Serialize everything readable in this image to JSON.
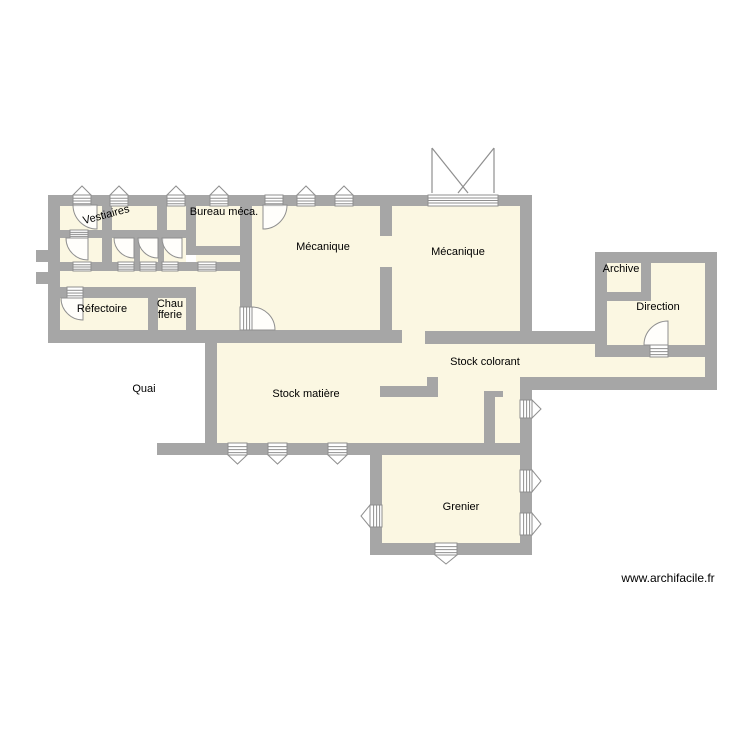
{
  "app": {
    "type": "floor-plan-export",
    "watermark": "www.archifacile.fr"
  },
  "colors": {
    "background": "#ffffff",
    "wall": "#a6a6a6",
    "room_fill": "#fbf7e2",
    "symbol_fill": "#ffffff",
    "symbol_stroke": "#8f8f8f",
    "label": "#000000"
  },
  "watermark_pos": {
    "x": 668,
    "y": 578
  },
  "rooms": [
    {
      "id": "vestiaires",
      "label": "Vestiaires",
      "x": 107,
      "y": 218,
      "rotate": -15
    },
    {
      "id": "bureau-meca",
      "label": "Bureau méca.",
      "x": 224,
      "y": 215
    },
    {
      "id": "mecanique-1",
      "label": "Mécanique",
      "x": 323,
      "y": 250
    },
    {
      "id": "mecanique-2",
      "label": "Mécanique",
      "x": 458,
      "y": 255
    },
    {
      "id": "archive",
      "label": "Archive",
      "x": 621,
      "y": 272
    },
    {
      "id": "direction",
      "label": "Direction",
      "x": 658,
      "y": 310
    },
    {
      "id": "refectoire",
      "label": "Réfectoire",
      "x": 102,
      "y": 312
    },
    {
      "id": "chaufferie",
      "label": "Chaufferie",
      "x": 170,
      "y": 311,
      "lines": [
        "Chau",
        "fferie"
      ]
    },
    {
      "id": "quai",
      "label": "Quai",
      "x": 144,
      "y": 392
    },
    {
      "id": "stock-matiere",
      "label": "Stock matière",
      "x": 306,
      "y": 397
    },
    {
      "id": "stock-colorant",
      "label": "Stock colorant",
      "x": 485,
      "y": 365
    },
    {
      "id": "grenier",
      "label": "Grenier",
      "x": 461,
      "y": 510
    }
  ],
  "geometry": {
    "room_fills": [
      [
        60,
        205,
        42,
        26
      ],
      [
        112,
        205,
        45,
        26
      ],
      [
        167,
        205,
        19,
        26
      ],
      [
        196,
        205,
        44,
        41
      ],
      [
        60,
        238,
        42,
        24
      ],
      [
        112,
        238,
        22,
        24
      ],
      [
        140,
        238,
        18,
        24
      ],
      [
        164,
        238,
        22,
        24
      ],
      [
        196,
        255,
        44,
        7
      ],
      [
        60,
        271,
        180,
        16
      ],
      [
        196,
        287,
        44,
        43
      ],
      [
        240,
        307,
        12,
        23
      ],
      [
        60,
        298,
        88,
        32
      ],
      [
        158,
        298,
        28,
        32
      ],
      [
        252,
        205,
        128,
        125
      ],
      [
        380,
        236,
        12,
        31
      ],
      [
        392,
        205,
        128,
        126
      ],
      [
        402,
        331,
        23,
        13
      ],
      [
        217,
        343,
        304,
        100
      ],
      [
        521,
        344,
        184,
        33
      ],
      [
        607,
        263,
        98,
        82
      ],
      [
        382,
        455,
        138,
        88
      ]
    ],
    "walls": [
      [
        48,
        195,
        484,
        11
      ],
      [
        48,
        195,
        12,
        148
      ],
      [
        36,
        250,
        12,
        12
      ],
      [
        36,
        272,
        12,
        12
      ],
      [
        102,
        205,
        10,
        26
      ],
      [
        157,
        205,
        10,
        26
      ],
      [
        186,
        205,
        10,
        50
      ],
      [
        60,
        230,
        126,
        8
      ],
      [
        186,
        246,
        66,
        9
      ],
      [
        102,
        238,
        10,
        24
      ],
      [
        134,
        238,
        6,
        24
      ],
      [
        158,
        238,
        6,
        24
      ],
      [
        60,
        262,
        192,
        9
      ],
      [
        48,
        287,
        148,
        11
      ],
      [
        148,
        298,
        10,
        32
      ],
      [
        186,
        298,
        10,
        32
      ],
      [
        48,
        330,
        354,
        13
      ],
      [
        205,
        330,
        12,
        125
      ],
      [
        240,
        195,
        12,
        112
      ],
      [
        380,
        195,
        12,
        41
      ],
      [
        380,
        267,
        12,
        63
      ],
      [
        520,
        195,
        12,
        136
      ],
      [
        425,
        331,
        107,
        13
      ],
      [
        427,
        377,
        11,
        20
      ],
      [
        380,
        386,
        58,
        11
      ],
      [
        484,
        391,
        19,
        6
      ],
      [
        484,
        397,
        11,
        46
      ],
      [
        532,
        331,
        75,
        13
      ],
      [
        595,
        252,
        122,
        11
      ],
      [
        595,
        252,
        12,
        105
      ],
      [
        705,
        252,
        12,
        138
      ],
      [
        607,
        292,
        44,
        9
      ],
      [
        641,
        263,
        10,
        38
      ],
      [
        595,
        345,
        122,
        12
      ],
      [
        520,
        377,
        197,
        13
      ],
      [
        520,
        390,
        12,
        165
      ],
      [
        157,
        443,
        226,
        12
      ],
      [
        383,
        443,
        149,
        12
      ],
      [
        370,
        443,
        12,
        112
      ],
      [
        370,
        543,
        162,
        12
      ]
    ],
    "windows_h": [
      {
        "x": 73,
        "y": 195,
        "w": 18,
        "h": 11,
        "tri": "up"
      },
      {
        "x": 110,
        "y": 195,
        "w": 18,
        "h": 11,
        "tri": "up"
      },
      {
        "x": 167,
        "y": 195,
        "w": 18,
        "h": 11,
        "tri": "up"
      },
      {
        "x": 210,
        "y": 195,
        "w": 18,
        "h": 11,
        "tri": "up"
      },
      {
        "x": 265,
        "y": 195,
        "w": 18,
        "h": 11,
        "tri": "none"
      },
      {
        "x": 297,
        "y": 195,
        "w": 18,
        "h": 11,
        "tri": "up"
      },
      {
        "x": 335,
        "y": 195,
        "w": 18,
        "h": 11,
        "tri": "up"
      },
      {
        "x": 70,
        "y": 230,
        "w": 18,
        "h": 8,
        "tri": "none"
      },
      {
        "x": 73,
        "y": 262,
        "w": 18,
        "h": 9,
        "tri": "none"
      },
      {
        "x": 118,
        "y": 262,
        "w": 16,
        "h": 9,
        "tri": "none"
      },
      {
        "x": 140,
        "y": 262,
        "w": 16,
        "h": 9,
        "tri": "none"
      },
      {
        "x": 162,
        "y": 262,
        "w": 16,
        "h": 9,
        "tri": "none"
      },
      {
        "x": 198,
        "y": 262,
        "w": 18,
        "h": 9,
        "tri": "none"
      },
      {
        "x": 67,
        "y": 287,
        "w": 16,
        "h": 11,
        "tri": "none"
      },
      {
        "x": 650,
        "y": 345,
        "w": 18,
        "h": 12,
        "tri": "none"
      },
      {
        "x": 228,
        "y": 443,
        "w": 19,
        "h": 12,
        "tri": "down"
      },
      {
        "x": 268,
        "y": 443,
        "w": 19,
        "h": 12,
        "tri": "down"
      },
      {
        "x": 328,
        "y": 443,
        "w": 19,
        "h": 12,
        "tri": "down"
      },
      {
        "x": 435,
        "y": 543,
        "w": 22,
        "h": 12,
        "tri": "down"
      }
    ],
    "windows_v": [
      {
        "x": 240,
        "y": 307,
        "w": 12,
        "h": 23,
        "tri": "none"
      },
      {
        "x": 520,
        "y": 400,
        "w": 12,
        "h": 18,
        "tri": "right"
      },
      {
        "x": 520,
        "y": 470,
        "w": 12,
        "h": 22,
        "tri": "right"
      },
      {
        "x": 520,
        "y": 513,
        "w": 12,
        "h": 22,
        "tri": "right"
      },
      {
        "x": 370,
        "y": 505,
        "w": 12,
        "h": 22,
        "tri": "left"
      }
    ],
    "doors": [
      "M97,205 L97,229 A24,24 0 0 1 73,205 Z",
      "M88,238 L88,260 A22,22 0 0 1 66,238 Z",
      "M134,238 L134,258 A20,20 0 0 1 114,238 Z",
      "M158,238 L158,258 A20,20 0 0 1 138,238 Z",
      "M182,238 L182,258 A20,20 0 0 1 162,238 Z",
      "M83,298 L83,320 A22,22 0 0 1 61,298 Z",
      "M263,205 L263,229 A24,24 0 0 0 287,205 Z",
      "M252,330 L252,307 A23,23 0 0 1 275,330 Z",
      "M668,345 L668,321 A24,24 0 0 0 644,345 Z"
    ],
    "garage": {
      "opening": [
        428,
        195,
        70,
        11
      ],
      "lines": [
        [
          432,
          148,
          432,
          193
        ],
        [
          494,
          148,
          494,
          193
        ],
        [
          432,
          148,
          468,
          193
        ],
        [
          494,
          148,
          458,
          193
        ]
      ]
    }
  }
}
